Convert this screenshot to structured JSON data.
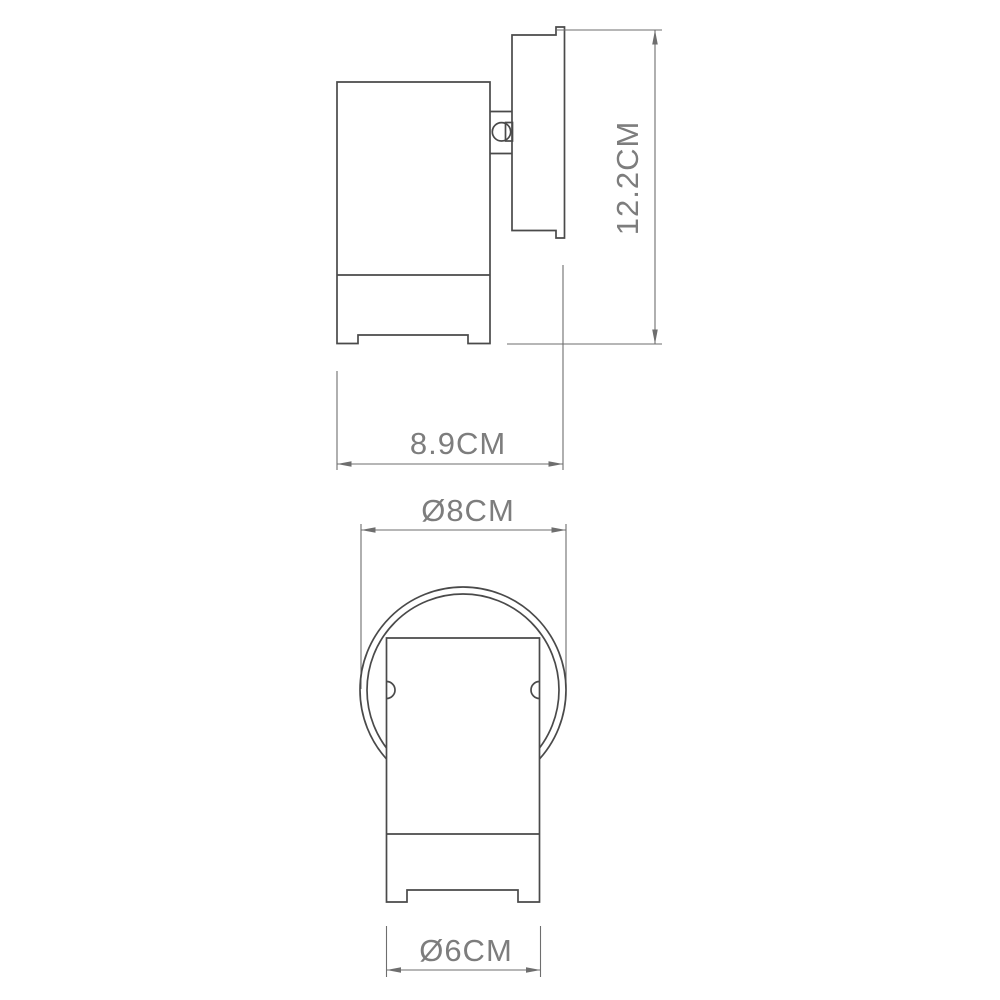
{
  "page": {
    "background_color": "#ffffff"
  },
  "drawing": {
    "colors": {
      "object_line": "#4a4a4a",
      "dimension_line": "#6e6e6e",
      "label_text": "#7d7d7d"
    },
    "views": {
      "side_view": {
        "height_label": "12.2CM",
        "width_label": "8.9CM"
      },
      "front_view": {
        "outer_diameter_label": "Ø8CM",
        "body_diameter_label": "Ø6CM"
      }
    }
  }
}
